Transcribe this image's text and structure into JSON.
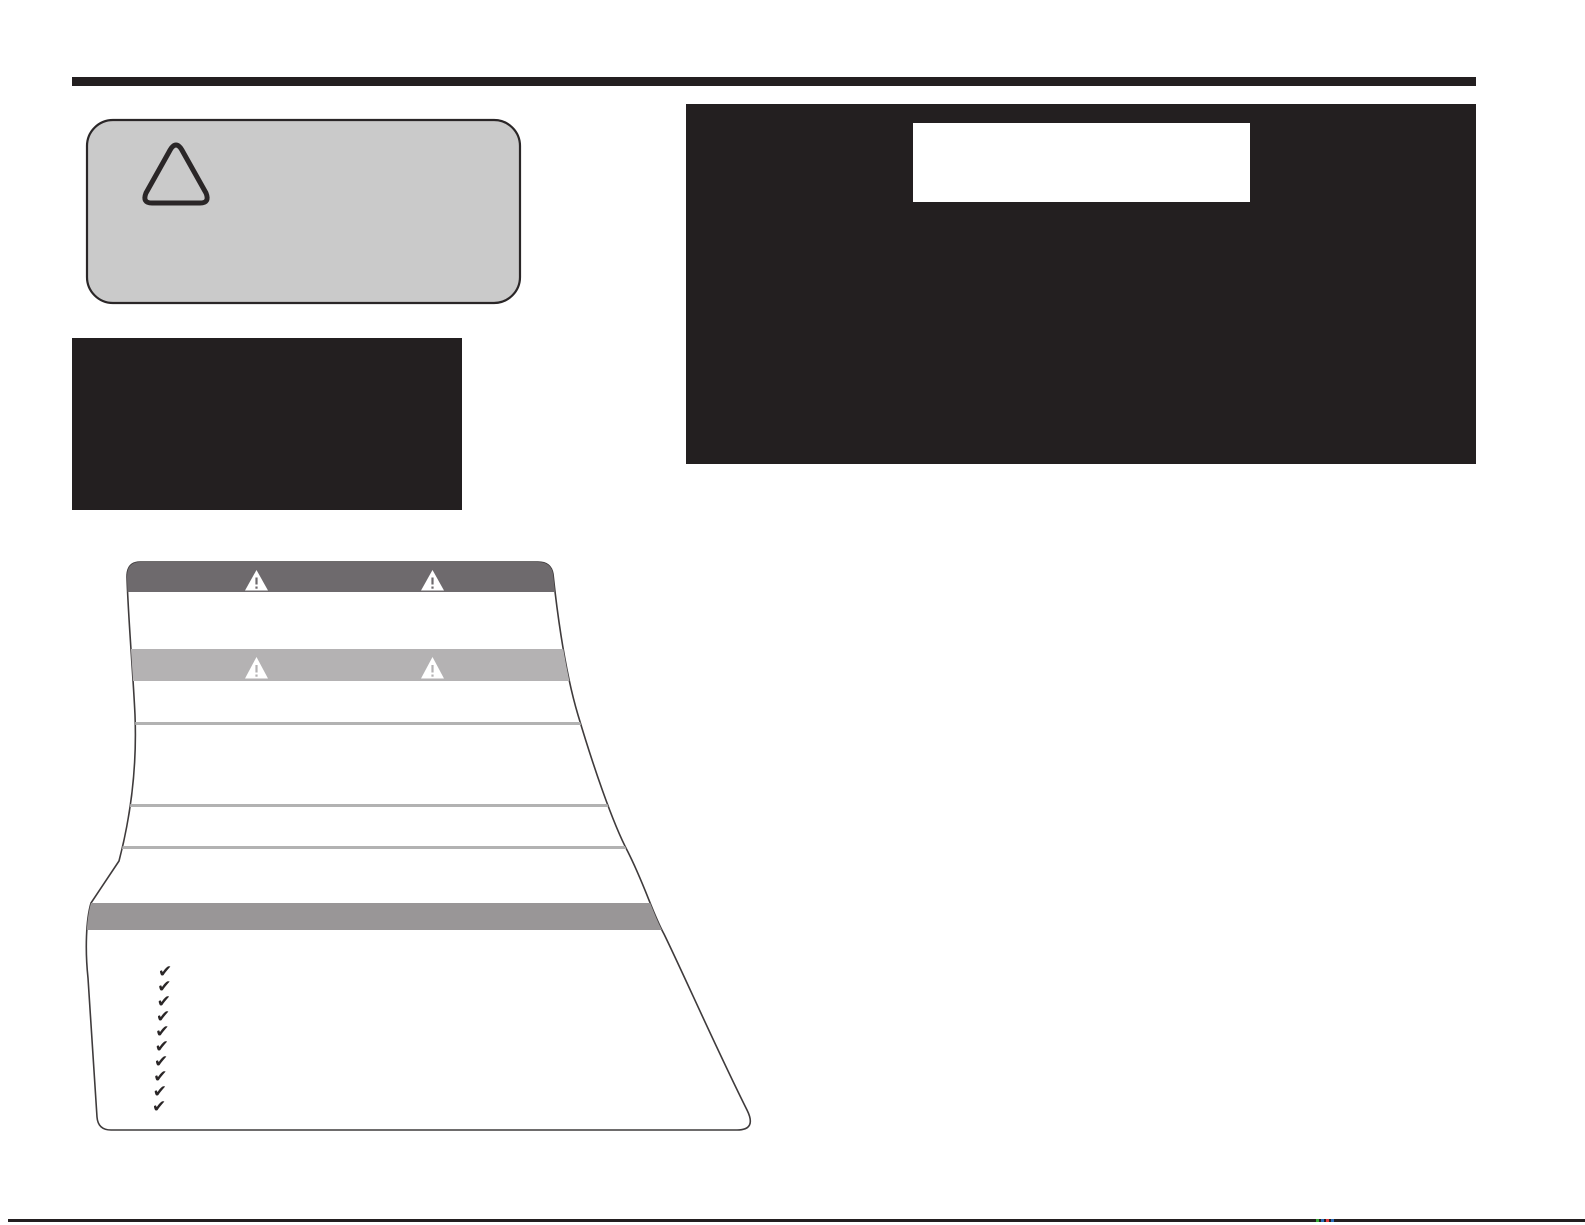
{
  "document": {
    "type": "printed-manual-safety-page",
    "notes": "Page contains no visible text: blank warning callout, two blank black panels, a blank safety-label diagram with warning bands and a ten-item checklist column, and horizontal rules."
  },
  "colors": {
    "ink_black": "#231f20",
    "callout_fill": "#cacaca",
    "callout_border": "#2a2627",
    "panel_black": "#231f20",
    "panel_window_white": "#ffffff",
    "label_fill": "#ffffff",
    "label_outline": "#3f3b3c",
    "header_band": "#6e6a6d",
    "caution_band": "#b4b2b3",
    "footer_band": "#999697",
    "divider_line": "#b2b2b2",
    "triangle_white": "#ffffff",
    "check_ink": "#2a2627",
    "reg_mark_green": "#3aaa35",
    "reg_mark_blue": "#2b6cb8",
    "reg_mark_red": "#e03a3e"
  },
  "glyphs": {
    "checkmark": "✔"
  },
  "safety_label": {
    "warning_icon": "triangle-exclamation",
    "header_triangle_count": 2,
    "caution_triangle_count": 2,
    "divider_count": 3,
    "checklist_count": 10
  }
}
